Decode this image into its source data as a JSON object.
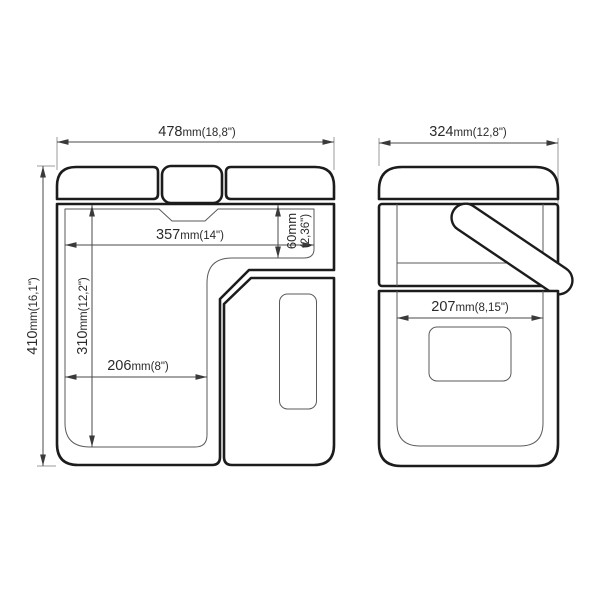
{
  "drawing": {
    "type": "technical-dimension-drawing",
    "subject": "portable cooler / compressor fridge, front and side elevation views",
    "views": [
      {
        "id": "front-view",
        "label": "front elevation"
      },
      {
        "id": "side-view",
        "label": "side elevation"
      }
    ],
    "colors": {
      "background": "#ffffff",
      "outline": "#1c1c1c",
      "inner_line": "#5a5a5a",
      "dimension_line": "#4a4a4a",
      "extension_line": "#9b9b9b",
      "text": "#2b2b2b"
    }
  },
  "dimensions": {
    "front_width": {
      "num": "478",
      "unit": "mm",
      "inch": "(18,8\")"
    },
    "front_height": {
      "num": "410",
      "unit": "mm",
      "inch": "(16,1\")"
    },
    "inner_width": {
      "num": "357",
      "unit": "mm",
      "inch": "(14\")"
    },
    "shelf_depth": {
      "num": "60",
      "unit": "mm",
      "inch": "(2,36\")"
    },
    "inner_height": {
      "num": "310",
      "unit": "mm",
      "inch": "(12,2\")"
    },
    "inner_lower_width": {
      "num": "206",
      "unit": "mm",
      "inch": "(8\")"
    },
    "side_width": {
      "num": "324",
      "unit": "mm",
      "inch": "(12,8\")"
    },
    "side_inner_width": {
      "num": "207",
      "unit": "mm",
      "inch": "(8,15\")"
    }
  }
}
